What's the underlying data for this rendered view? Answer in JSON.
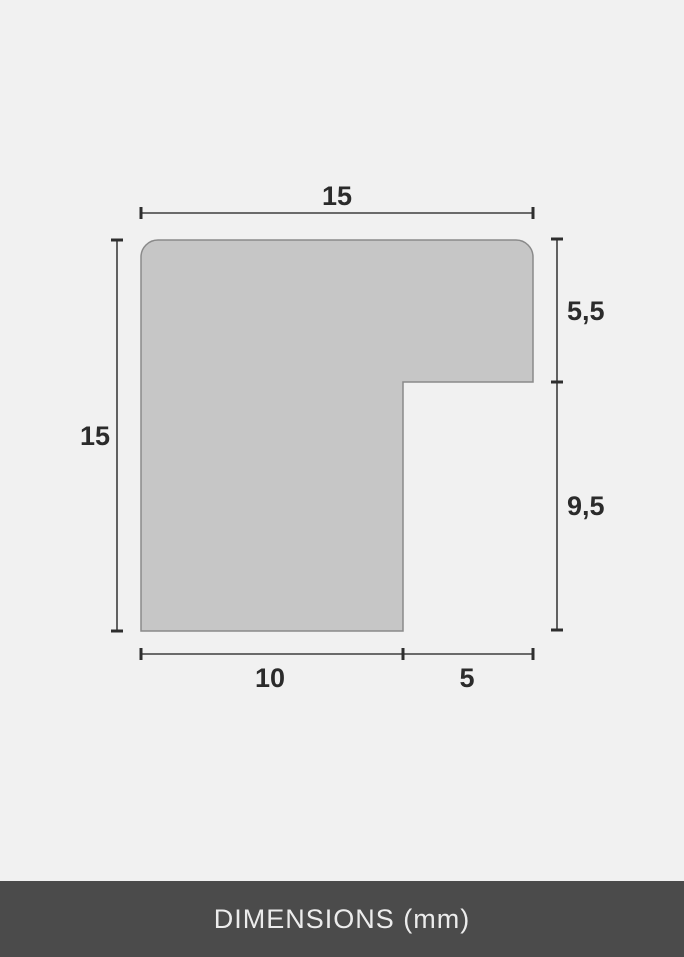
{
  "colors": {
    "background": "#f1f1f1",
    "shape_fill": "#c6c6c6",
    "shape_outline": "#8a8a8a",
    "dimension_line": "#3d3d3d",
    "label_text": "#2b2b2b",
    "footer_background": "#4b4b4b",
    "footer_text": "#ececec"
  },
  "diagram": {
    "description": "Cross-section profile of a frame moulding with dimension lines",
    "labels": {
      "top_width": "15",
      "left_height": "15",
      "right_upper": "5,5",
      "right_lower": "9,5",
      "bottom_inner": "10",
      "bottom_outer": "5"
    }
  },
  "footer": {
    "text": "DIMENSIONS (mm)"
  }
}
